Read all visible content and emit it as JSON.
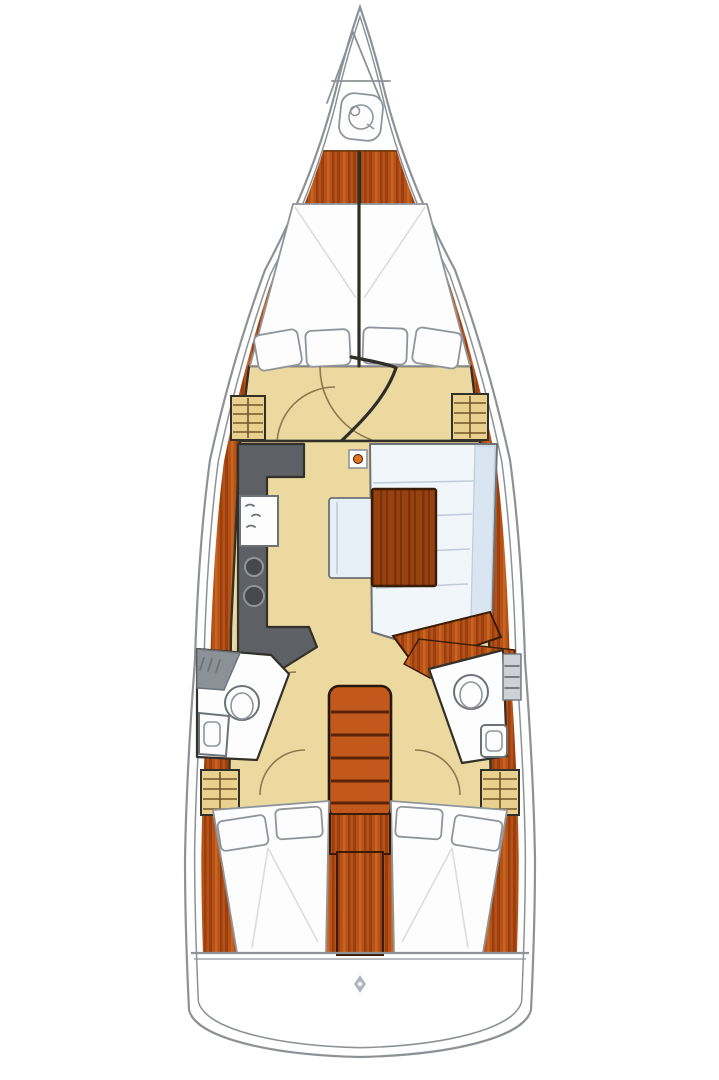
{
  "meta": {
    "title": "Sailboat interior layout plan",
    "type": "boat-floorplan",
    "view": "top-down"
  },
  "colors": {
    "bg": "#ffffff",
    "hull-line": "#8e9296",
    "wood": "#b5521a",
    "wood-streak-dark": "#9c3f0c",
    "wood-streak-light": "#c9651f",
    "wood-edge": "#3a1c06",
    "wood-table": "#96410f",
    "wood-table-dark": "#7c330a",
    "floor": "#ecd9a0",
    "locker": "#e9d08e",
    "locker-stripe": "#6f5526",
    "outline": "#33302a",
    "galley": "#5d6165",
    "galley-dark": "#45484c",
    "white": "#fdfdfd",
    "soft-stroke": "#8f959a",
    "sheet-line": "#dcdcdc",
    "sofa": "#f1f6fa",
    "sofa-back": "#d9e6f1",
    "sofa-seam": "#bfccd9",
    "bench": "#e7eff7",
    "stairs": "#c2581c",
    "stair-edge": "#26180c",
    "stair-tread": "#5b2408",
    "fixture": "#6d7277",
    "slat": "#cdd2d6",
    "shower": "#8b9196",
    "arc": "#8c7a4f",
    "door": "#2f2d28",
    "mast-dot": "#e2731f",
    "icon-gray": "#b2b6bb"
  },
  "regions": [
    {
      "id": "anchor-locker",
      "label": "Bow anchor locker with windlass"
    },
    {
      "id": "forward-cabin",
      "label": "Forward cabin V-berth with 4 pillows"
    },
    {
      "id": "galley",
      "label": "Port galley with sink and 2-burner stove"
    },
    {
      "id": "salon",
      "label": "Starboard salon with L-sofa, bench and wood table"
    },
    {
      "id": "head-port",
      "label": "Port head with toilet and sink"
    },
    {
      "id": "head-starboard",
      "label": "Starboard head with toilet and sink"
    },
    {
      "id": "companionway",
      "label": "Companionway stairs with 5 treads"
    },
    {
      "id": "aft-cabin-port",
      "label": "Port aft cabin double berth with 2 pillows"
    },
    {
      "id": "aft-cabin-starboard",
      "label": "Starboard aft cabin double berth with 2 pillows"
    },
    {
      "id": "transom",
      "label": "Stern swim platform"
    }
  ],
  "icons": [
    {
      "name": "windlass-icon",
      "meaning": "anchor windlass at bow"
    },
    {
      "name": "mast-step-icon",
      "meaning": "mast compression post"
    },
    {
      "name": "burner-icon",
      "meaning": "galley stove burner",
      "count": 2
    },
    {
      "name": "faucet-icon",
      "meaning": "galley sink taps"
    },
    {
      "name": "toilet-icon",
      "meaning": "marine toilet",
      "count": 2
    },
    {
      "name": "transom-logo-icon",
      "meaning": "small stern emblem"
    }
  ],
  "counts": {
    "forward_pillows": 4,
    "aft_pillows_per_cabin": 2,
    "stair_treads": 5,
    "heads": 2,
    "cabins": 3
  }
}
